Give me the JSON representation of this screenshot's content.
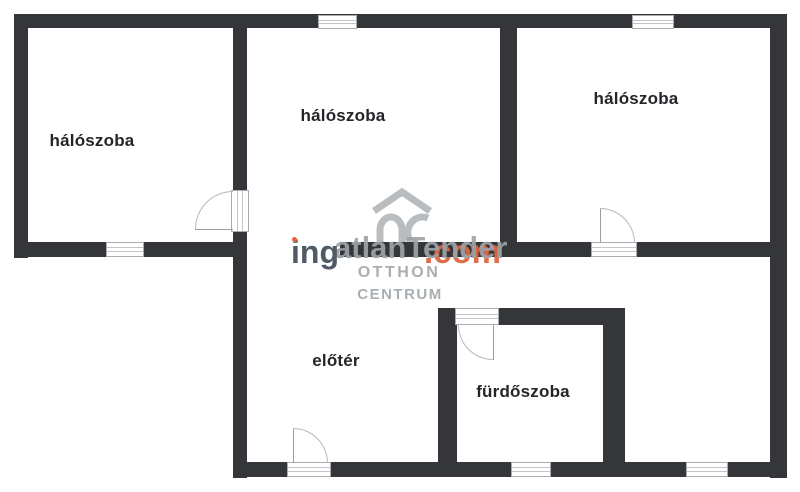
{
  "plan": {
    "rooms": [
      {
        "label": "hálószoba"
      },
      {
        "label": "hálószoba"
      },
      {
        "label": "hálószoba"
      },
      {
        "label": "előtér"
      },
      {
        "label": "fürdőszoba"
      }
    ],
    "watermark": {
      "brand_prefix": "ing",
      "brand_overlay": "atlanTender",
      "brand_suffix": ".com",
      "agency_line1": "OTTHON",
      "agency_line2": "CENTRUM",
      "logo_icon": "oc-house-logo"
    },
    "colors": {
      "wall": "#343639",
      "accent_orange": "#e0663f",
      "watermark_gray": "#9ea3a8",
      "label": "#232528",
      "symbol_gray": "#a9acb0",
      "brand_dark": "#4f5b66",
      "logo_gray": "#b9bdc0"
    }
  }
}
